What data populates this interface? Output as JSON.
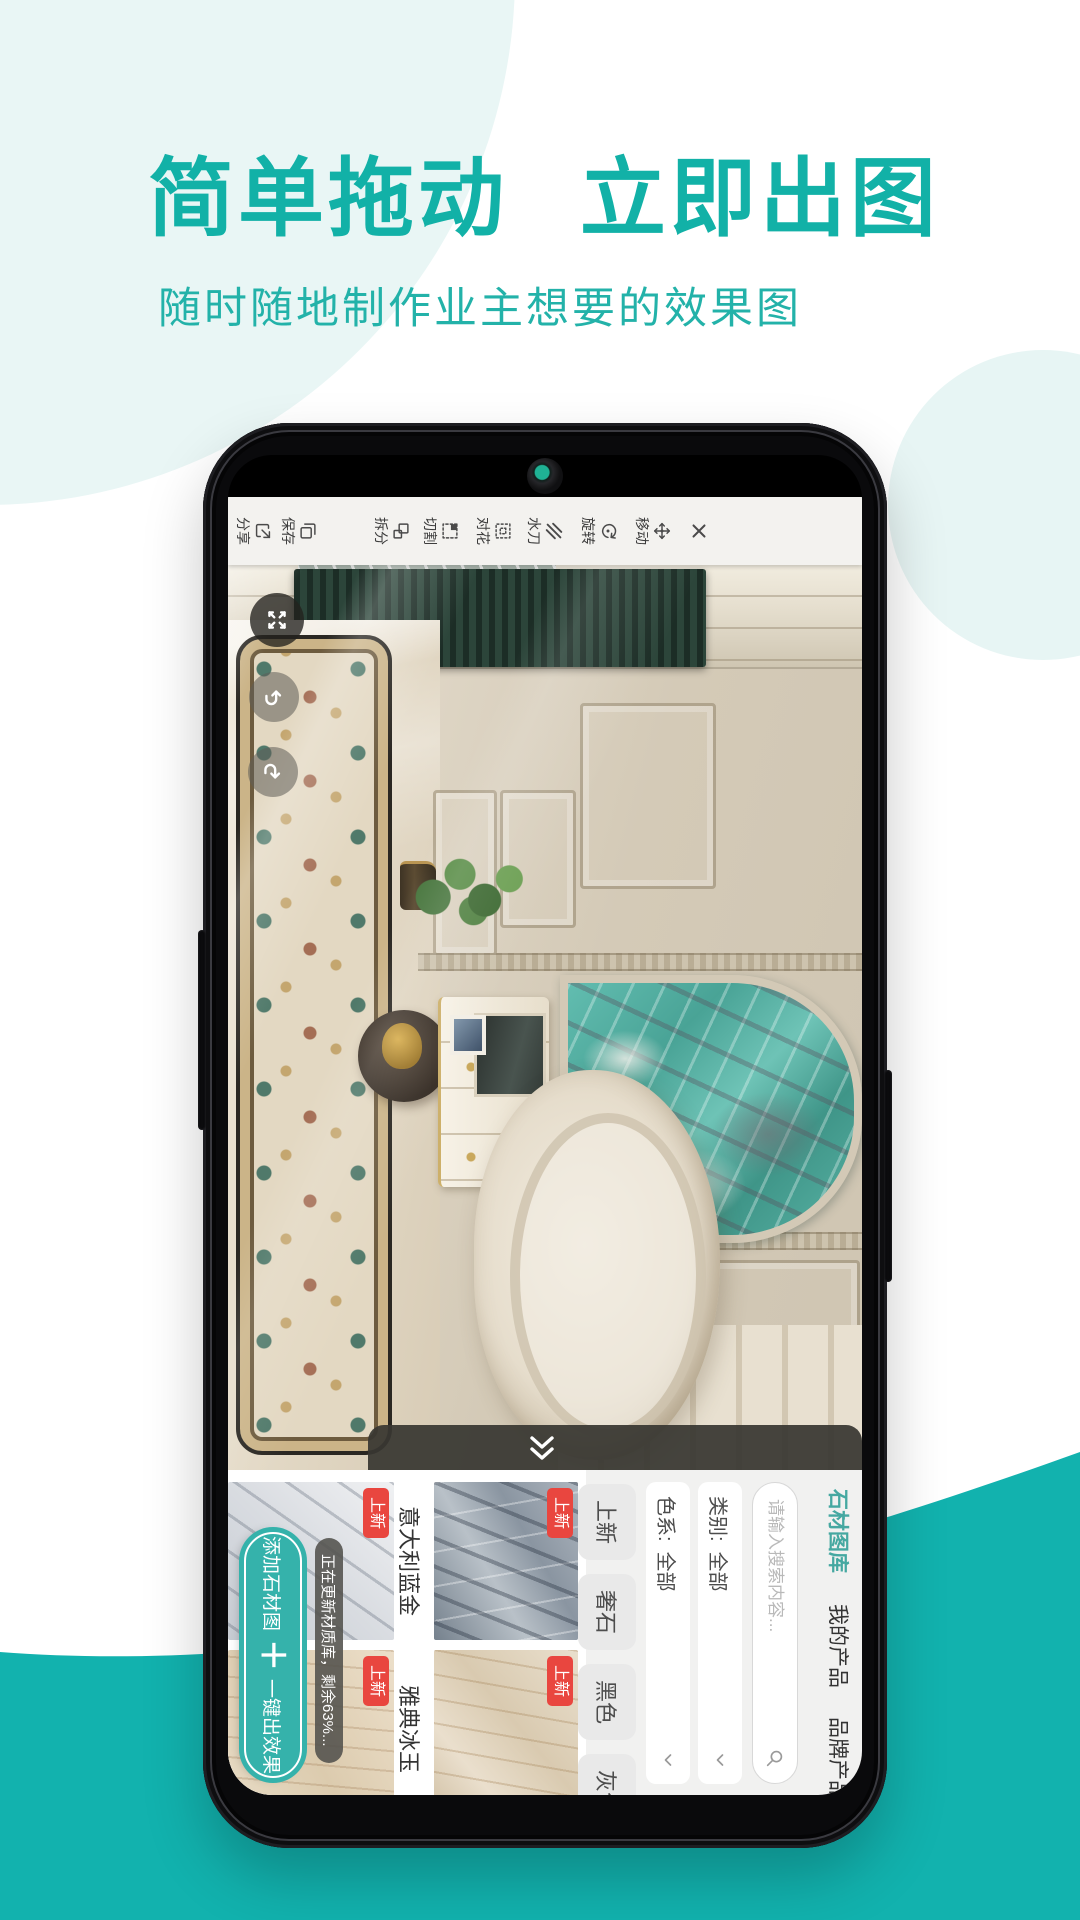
{
  "page": {
    "title": "简单拖动 立即出图",
    "subtitle": "随时随地制作业主想要的效果图"
  },
  "colors": {
    "accent": "#12b1a7",
    "wave_teal": "#12b2ae",
    "bg_circle_tint": "#e9f6f5",
    "badge_red": "#e9463f",
    "tab_active": "#45a8a1",
    "fab_teal": "#35b2ab",
    "stone_turquoise": "#4aab9d"
  },
  "app": {
    "toolbar": {
      "close_icon": "close-x",
      "items": [
        {
          "label": "移动",
          "icon": "move-arrows-icon"
        },
        {
          "label": "旋转",
          "icon": "rotate-arrow-icon"
        },
        {
          "label": "水刀",
          "icon": "waterjet-lines-icon"
        },
        {
          "label": "对花",
          "icon": "pattern-dots-icon"
        },
        {
          "label": "切割",
          "icon": "cut-square-icon"
        },
        {
          "label": "拆分",
          "icon": "split-squares-icon"
        },
        {
          "label": "保存",
          "icon": "save-copy-icon"
        },
        {
          "label": "分享",
          "icon": "share-box-icon"
        }
      ]
    },
    "canvas_buttons": [
      {
        "icon": "fullscreen-arrows-icon"
      },
      {
        "icon": "undo-arrow-icon"
      },
      {
        "icon": "redo-arrow-icon"
      }
    ],
    "collapse_icon": "double-chevron-icon",
    "panel": {
      "tabs": [
        {
          "label": "石材图库",
          "active": true
        },
        {
          "label": "我的产品",
          "active": false
        },
        {
          "label": "品牌产品",
          "active": false
        }
      ],
      "search_placeholder": "请输入搜索内容...",
      "filters": [
        {
          "label": "类别:",
          "value": "全部"
        },
        {
          "label": "色系:",
          "value": "全部"
        }
      ],
      "chips": [
        {
          "label": "上新"
        },
        {
          "label": "奢石"
        },
        {
          "label": "黑色"
        },
        {
          "label": "灰色"
        }
      ],
      "stones": [
        {
          "name": "意大利蓝金",
          "badge": "上新"
        },
        {
          "name": "雅典冰玉",
          "badge": "上新"
        },
        {
          "badge": "上新"
        },
        {
          "badge": "上新"
        }
      ],
      "toast": "正在更新材质库，剩余63%...",
      "add_button": {
        "left": "添加石材图",
        "plus": "＋",
        "right": "一键出效果"
      }
    }
  }
}
